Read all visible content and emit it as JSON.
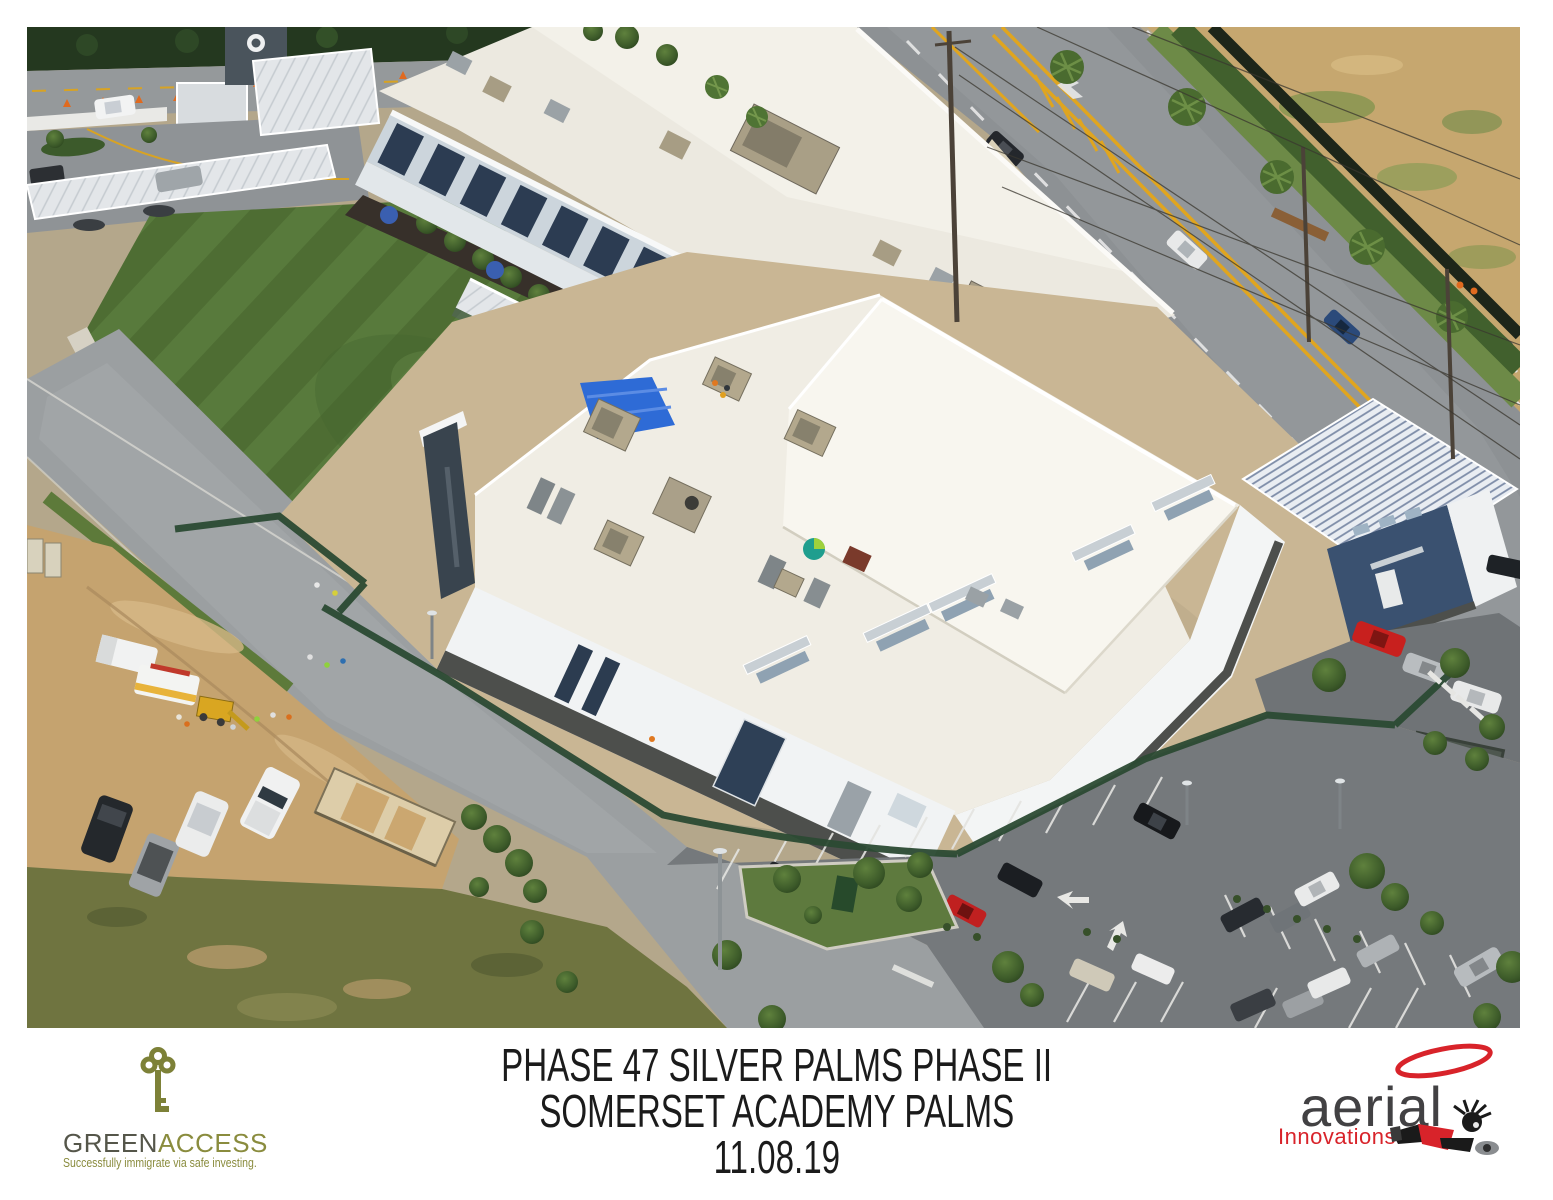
{
  "page": {
    "background": "#ffffff"
  },
  "caption": {
    "line1": "PHASE 47 SILVER PALMS PHASE II",
    "line2": "SOMERSET ACADEMY PALMS",
    "line3": "11.08.19",
    "text_color": "#1b1b1b"
  },
  "logos": {
    "greenaccess": {
      "word_green": "GREEN",
      "word_access": "ACCESS",
      "tagline": "Successfully immigrate via safe investing.",
      "color_dark": "#55564a",
      "color_olive": "#8a8c3e"
    },
    "aerial_innovations": {
      "word": "aerial",
      "sub": "Innovations",
      "color_gray": "#424143",
      "color_red": "#d8232a"
    }
  },
  "photo": {
    "palette": {
      "turf_green": "#4e6d33",
      "roof_white": "#efece2",
      "asphalt": "#8d9194",
      "dirt_tan": "#c5a36f",
      "construction_fence_green": "#2b4a33",
      "building_accent_navy": "#2c3c52"
    }
  }
}
